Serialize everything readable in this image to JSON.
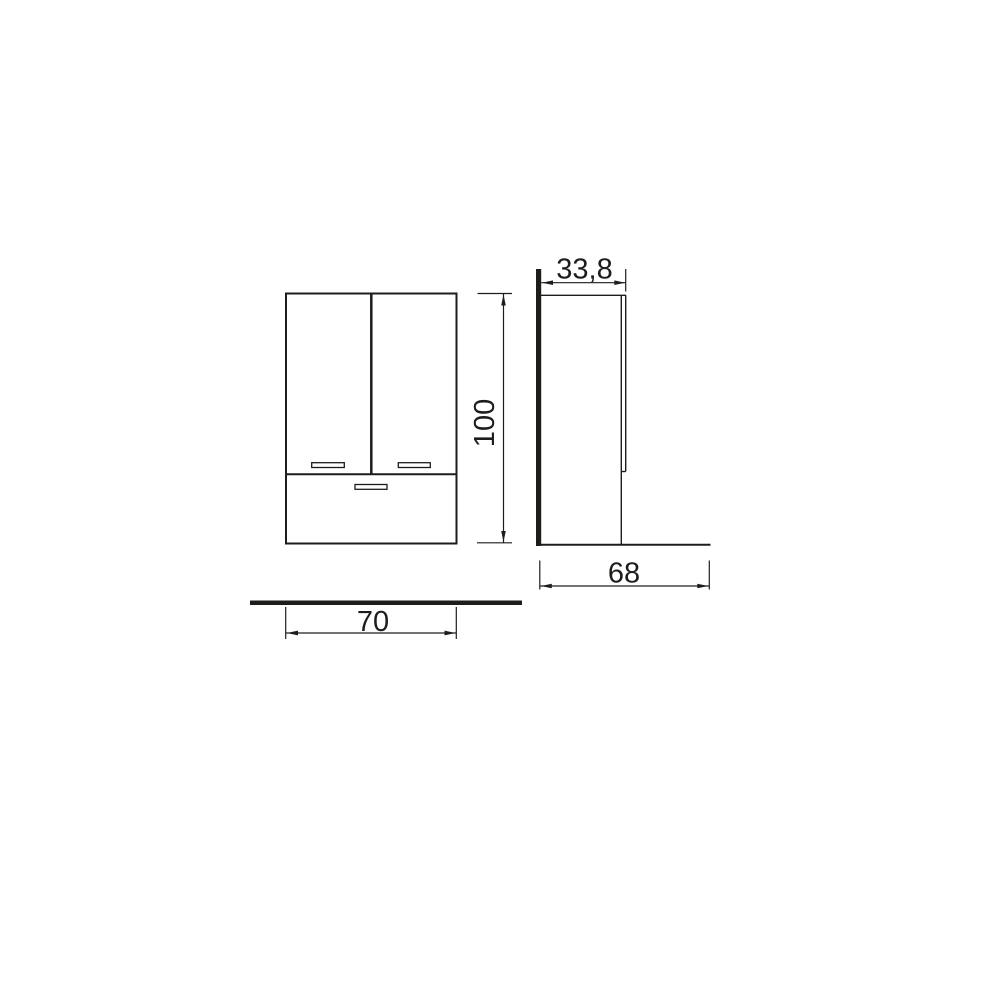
{
  "page": {
    "background_color": "#ffffff",
    "line_color": "#1d1d1b"
  },
  "drawing": {
    "type": "furniture-technical-drawing",
    "views": {
      "front": {
        "width_dimension": "70",
        "height_dimension": "100"
      },
      "side": {
        "top_depth_dimension": "33,8",
        "bottom_depth_dimension": "68"
      }
    }
  }
}
